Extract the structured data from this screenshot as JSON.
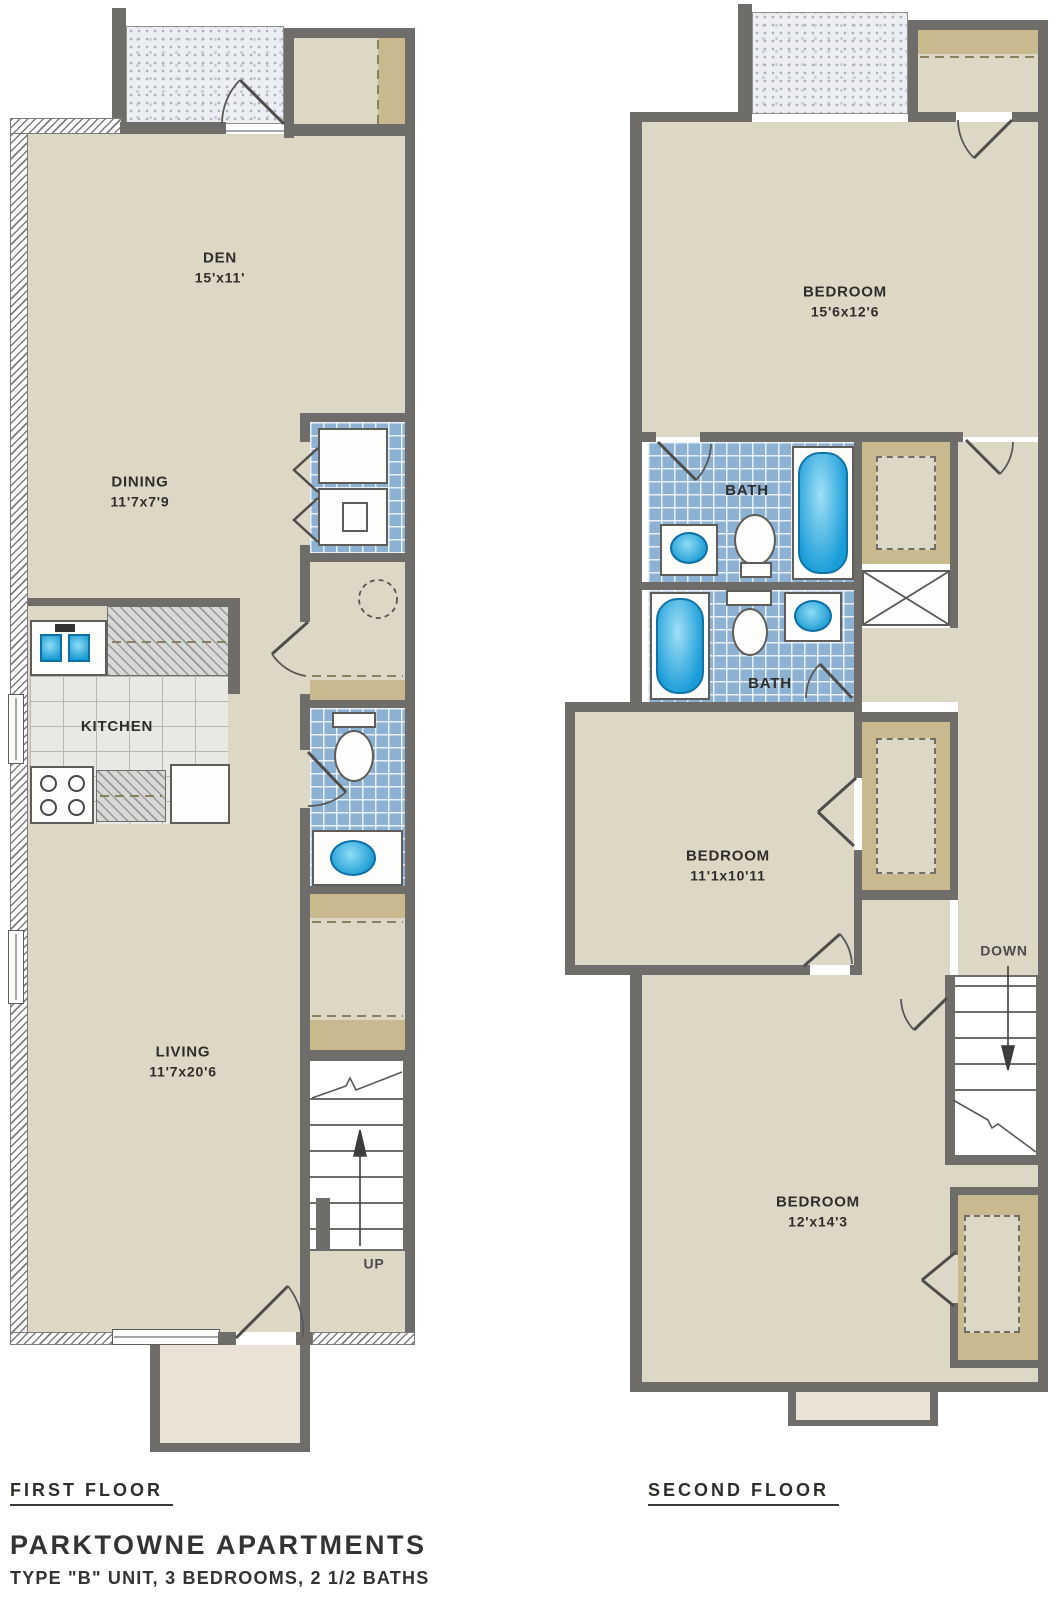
{
  "title": "PARKTOWNE APARTMENTS",
  "subtitle": "TYPE \"B\" UNIT, 3 BEDROOMS, 2 1/2 BATHS",
  "first_floor": {
    "caption": "FIRST FLOOR",
    "stairs_label": "UP",
    "rooms": {
      "den": {
        "name": "DEN",
        "dims": "15'x11'"
      },
      "dining": {
        "name": "DINING",
        "dims": "11'7x7'9"
      },
      "kitchen": {
        "name": "KITCHEN"
      },
      "living": {
        "name": "LIVING",
        "dims": "11'7x20'6"
      }
    }
  },
  "second_floor": {
    "caption": "SECOND FLOOR",
    "stairs_label": "DOWN",
    "rooms": {
      "bedroom_top": {
        "name": "BEDROOM",
        "dims": "15'6x12'6"
      },
      "bath_upper": {
        "name": "BATH"
      },
      "bath_lower": {
        "name": "BATH"
      },
      "bedroom_middle": {
        "name": "BEDROOM",
        "dims": "11'1x10'11"
      },
      "bedroom_bottom": {
        "name": "BEDROOM",
        "dims": "12'x14'3"
      }
    }
  },
  "colors": {
    "wall": "#6f6d69",
    "floor": "#ddd8c6",
    "closet_tan": "#c8ba8e",
    "tile_blue": "#8cb1d2",
    "fixture_blue": "#2aa6da",
    "patio_stipple": "#eceef2",
    "counter_gray": "#d8d8d6"
  }
}
